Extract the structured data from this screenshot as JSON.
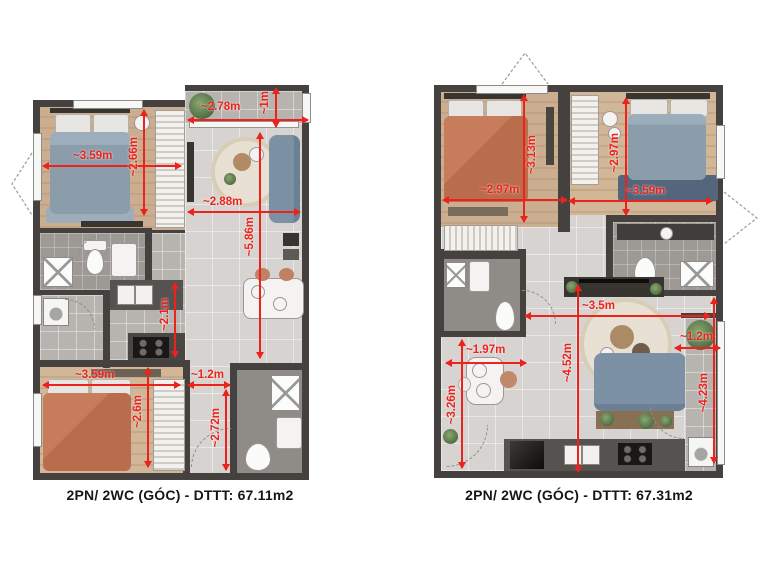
{
  "colors": {
    "dimension_red": "#ec221c",
    "wall_dark": "#45413e",
    "caption_text": "#161616"
  },
  "plans": [
    {
      "id": "left-unit",
      "caption": "2PN/ 2WC (GÓC) - DTTT: 67.11m2",
      "dimensions": [
        {
          "name": "balcony-width",
          "label": "~2.78m",
          "orientation": "horizontal"
        },
        {
          "name": "balcony-depth",
          "label": "~1m",
          "orientation": "vertical"
        },
        {
          "name": "bedroom1-width",
          "label": "~3.59m",
          "orientation": "horizontal"
        },
        {
          "name": "bedroom1-depth",
          "label": "~2.66m",
          "orientation": "vertical"
        },
        {
          "name": "living-width",
          "label": "~2.88m",
          "orientation": "horizontal"
        },
        {
          "name": "living-length",
          "label": "~5.86m",
          "orientation": "vertical"
        },
        {
          "name": "kitchen-length",
          "label": "~2.1m",
          "orientation": "vertical"
        },
        {
          "name": "bedroom2-width",
          "label": "~3.59m",
          "orientation": "horizontal"
        },
        {
          "name": "bedroom2-depth",
          "label": "~2.6m",
          "orientation": "vertical"
        },
        {
          "name": "hall-width",
          "label": "~1.2m",
          "orientation": "horizontal"
        },
        {
          "name": "hall-length",
          "label": "~2.72m",
          "orientation": "vertical"
        }
      ]
    },
    {
      "id": "right-unit",
      "caption": "2PN/ 2WC (GÓC) - DTTT: 67.31m2",
      "dimensions": [
        {
          "name": "bedroom1-width",
          "label": "~2.97m",
          "orientation": "horizontal"
        },
        {
          "name": "bedroom1-depth",
          "label": "~3.13m",
          "orientation": "vertical"
        },
        {
          "name": "bedroom2-depth",
          "label": "~2.97m",
          "orientation": "vertical"
        },
        {
          "name": "bedroom2-width",
          "label": "~3.59m",
          "orientation": "horizontal"
        },
        {
          "name": "living-width",
          "label": "~3.5m",
          "orientation": "horizontal"
        },
        {
          "name": "dining-width",
          "label": "~1.97m",
          "orientation": "horizontal"
        },
        {
          "name": "dining-length",
          "label": "~3.26m",
          "orientation": "vertical"
        },
        {
          "name": "living-length",
          "label": "~4.52m",
          "orientation": "vertical"
        },
        {
          "name": "balcony-width",
          "label": "~1.2m",
          "orientation": "horizontal"
        },
        {
          "name": "balcony-length",
          "label": "~4.23m",
          "orientation": "vertical"
        }
      ]
    }
  ]
}
